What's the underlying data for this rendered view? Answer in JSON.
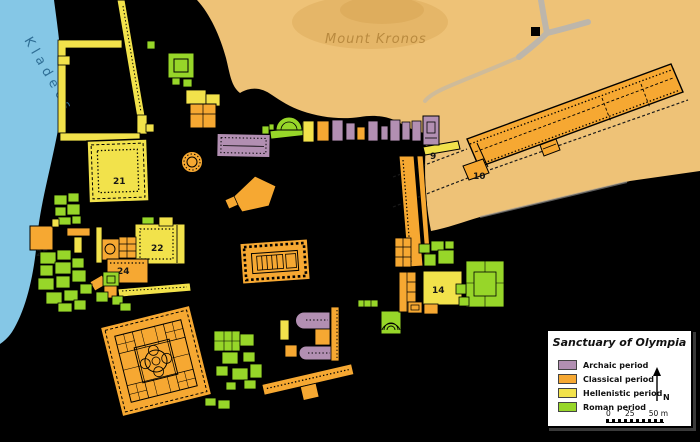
{
  "map": {
    "river_label": "Kladeos",
    "hill_label": "Mount Kronos",
    "labels": {
      "b9": "9",
      "b10": "10",
      "b14": "14",
      "b21": "21",
      "b22": "22",
      "b24": "24",
      "b25": "25"
    }
  },
  "legend": {
    "title": "Sanctuary of Olympia",
    "items": [
      {
        "label": "Archaic period",
        "key": "archaic"
      },
      {
        "label": "Classical period",
        "key": "classical"
      },
      {
        "label": "Hellenistic period",
        "key": "hellenistic"
      },
      {
        "label": "Roman period",
        "key": "roman"
      }
    ],
    "north_label": "N",
    "scale_ticks": [
      "0",
      "25",
      "50 m"
    ]
  },
  "colors": {
    "archaic": "#b28fb2",
    "classical": "#f6a832",
    "hellenistic": "#f2e24b",
    "roman": "#97d629",
    "river": "#85c7e6",
    "hill": "#eec277",
    "hill_shade": "#e2b263",
    "hill_label": "#b98a3f",
    "river_label": "#2f6e95",
    "background": "#000000",
    "road": "#b5b5b5",
    "legend_bg": "#ffffff"
  }
}
